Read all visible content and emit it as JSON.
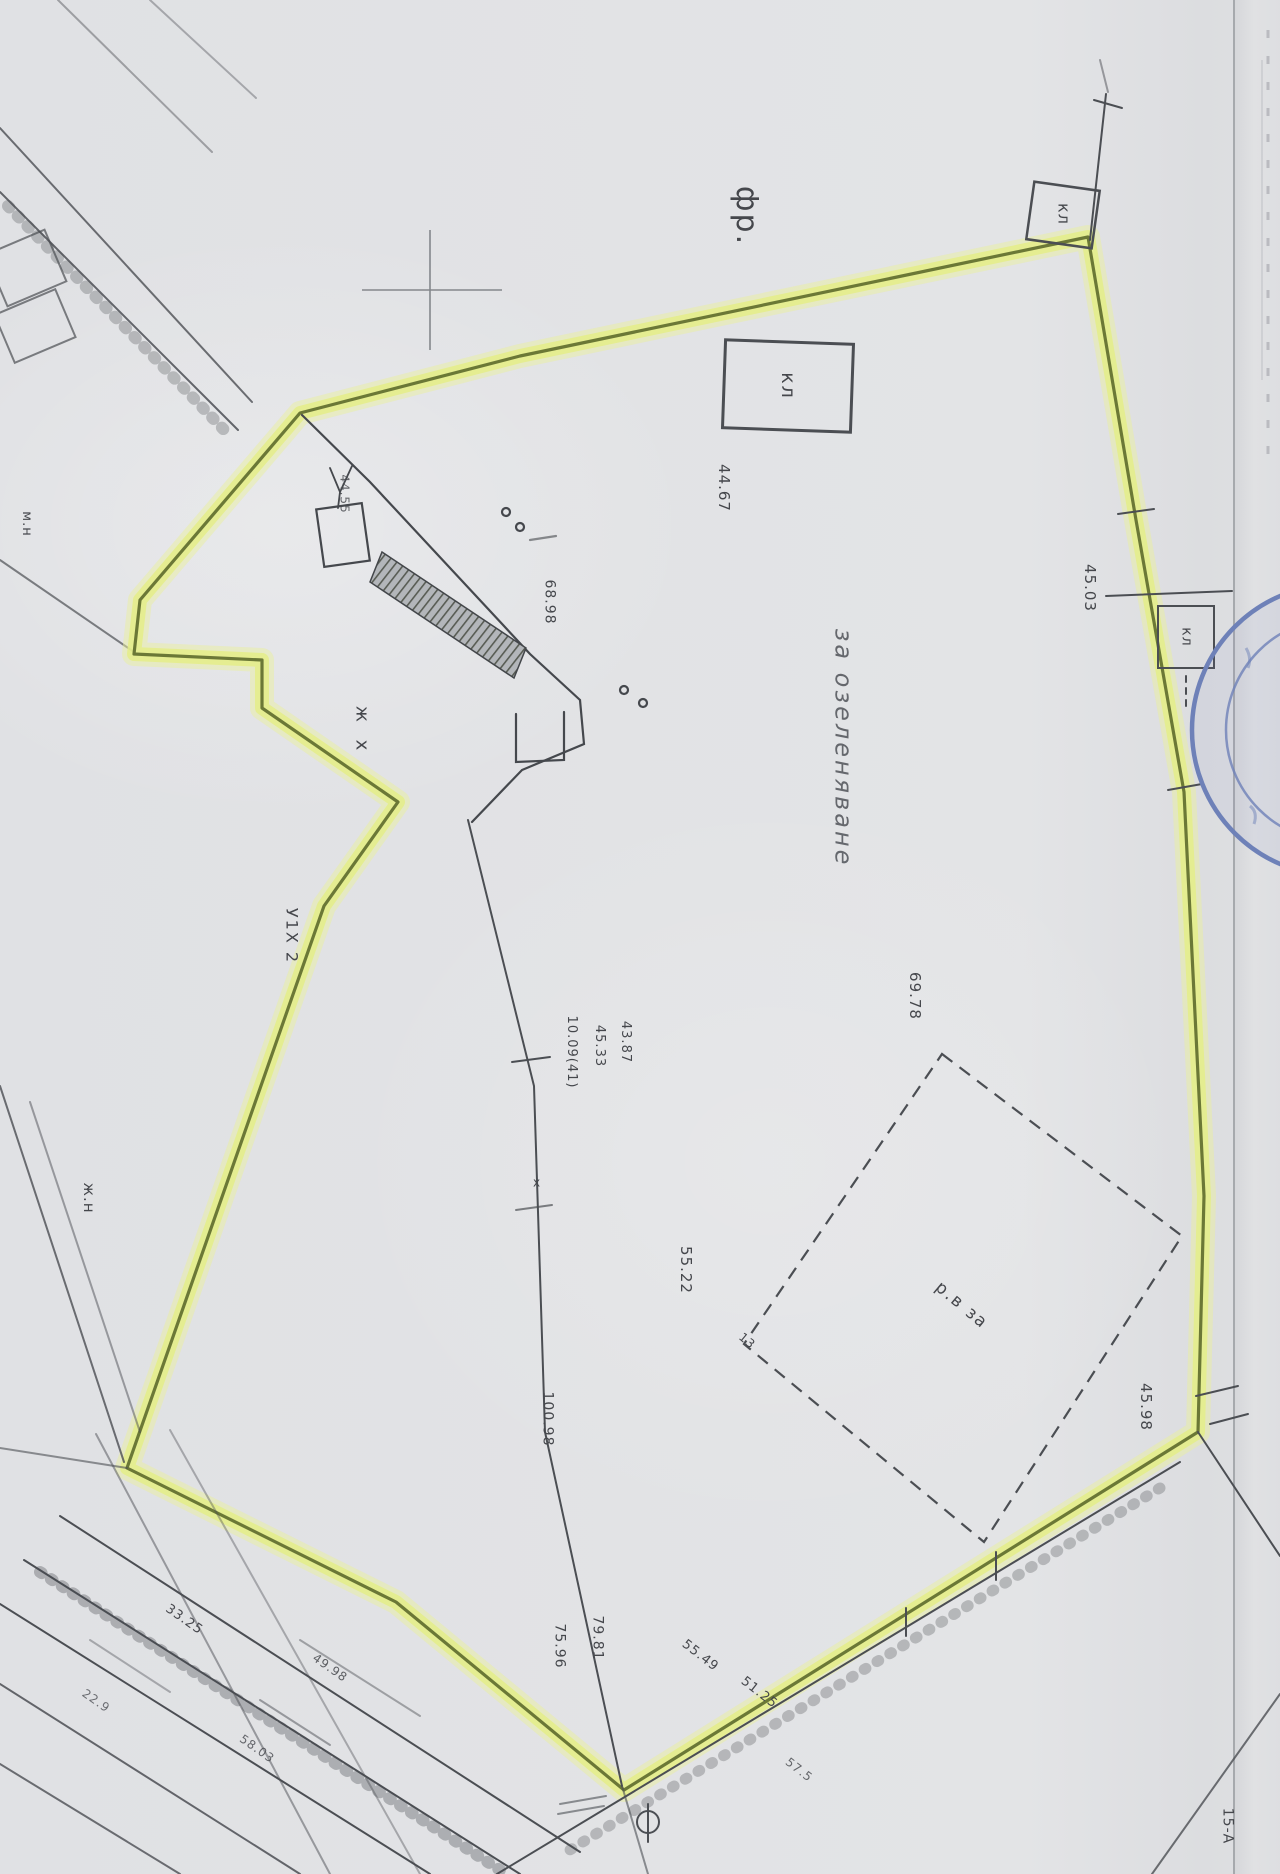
{
  "colors": {
    "paper": "#e2e3e5",
    "ink": "#4b4e53",
    "highlight_fill": "rgba(228,237,136,0.85)",
    "highlight_line": "#6b7836",
    "stamp_blue": "#6e81b8",
    "cross_gray": "#84878c"
  },
  "scan": {
    "kind_label": "cadastral plan scan",
    "highlighted_area": "parcel boundary marked with yellow highlighter"
  },
  "labels": [
    {
      "name": "label-fr",
      "text": "фр.",
      "x": 746,
      "y": 216,
      "rot": 90,
      "fs": 30,
      "ls": 2
    },
    {
      "name": "label-kl-top-right-box",
      "text": "кл",
      "x": 1063,
      "y": 214,
      "rot": 90,
      "fs": 16,
      "ls": 1
    },
    {
      "name": "label-kl-top-box",
      "text": "кл",
      "x": 787,
      "y": 386,
      "rot": 90,
      "fs": 19,
      "ls": 2
    },
    {
      "name": "measurement-44-67",
      "text": "44.67",
      "x": 723,
      "y": 488,
      "rot": 90,
      "fs": 15
    },
    {
      "name": "measurement-68-98",
      "text": "68.98",
      "x": 549,
      "y": 602,
      "rot": 90,
      "fs": 14
    },
    {
      "name": "measurement-45-03",
      "text": "45.03",
      "x": 1089,
      "y": 588,
      "rot": 90,
      "fs": 15
    },
    {
      "name": "label-kl-right-box",
      "text": "кл",
      "x": 1186,
      "y": 637,
      "rot": 90,
      "fs": 14
    },
    {
      "name": "note-center",
      "text": "за озеленяване",
      "x": 843,
      "y": 748,
      "rot": 90,
      "fs": 24,
      "ls": 3,
      "italic": true,
      "color": "#585b61",
      "op": 0.9
    },
    {
      "name": "label-zh-x",
      "text": "ж х",
      "x": 361,
      "y": 731,
      "rot": 90,
      "fs": 18,
      "ls": 6
    },
    {
      "name": "label-upi",
      "text": "У1Х 2",
      "x": 291,
      "y": 936,
      "rot": 90,
      "fs": 16,
      "ls": 2
    },
    {
      "name": "label-m-n",
      "text": "м.н",
      "x": 26,
      "y": 524,
      "rot": 90,
      "fs": 13
    },
    {
      "name": "label-zh-n",
      "text": "ж.н",
      "x": 88,
      "y": 1198,
      "rot": 90,
      "fs": 15
    },
    {
      "name": "measurement-69-78",
      "text": "69.78",
      "x": 914,
      "y": 996,
      "rot": 90,
      "fs": 15
    },
    {
      "name": "measurement-10-09",
      "text": "10.09(41)",
      "x": 571,
      "y": 1052,
      "rot": 90,
      "fs": 13
    },
    {
      "name": "measurement-45-33",
      "text": "45.33",
      "x": 599,
      "y": 1046,
      "rot": 90,
      "fs": 13
    },
    {
      "name": "measurement-43-87",
      "text": "43.87",
      "x": 625,
      "y": 1042,
      "rot": 90,
      "fs": 13
    },
    {
      "name": "measurement-55-22",
      "text": "55.22",
      "x": 685,
      "y": 1270,
      "rot": 90,
      "fs": 15
    },
    {
      "name": "measurement-13",
      "text": "13",
      "x": 747,
      "y": 1341,
      "rot": 40,
      "fs": 12
    },
    {
      "name": "note-diamond",
      "text": "р.в за",
      "x": 961,
      "y": 1306,
      "rot": 40,
      "fs": 17,
      "ls": 2
    },
    {
      "name": "measurement-100-98",
      "text": "100.98",
      "x": 547,
      "y": 1419,
      "rot": 90,
      "fs": 14
    },
    {
      "name": "measurement-45-98",
      "text": "45.98",
      "x": 1145,
      "y": 1407,
      "rot": 90,
      "fs": 15
    },
    {
      "name": "measurement-75-96",
      "text": "75.96",
      "x": 559,
      "y": 1646,
      "rot": 90,
      "fs": 14
    },
    {
      "name": "measurement-79-81",
      "text": "79.81",
      "x": 597,
      "y": 1638,
      "rot": 90,
      "fs": 14
    },
    {
      "name": "measurement-55-49",
      "text": "55.49",
      "x": 700,
      "y": 1656,
      "rot": 38,
      "fs": 13
    },
    {
      "name": "measurement-51-25",
      "text": "51.25",
      "x": 759,
      "y": 1693,
      "rot": 38,
      "fs": 13
    },
    {
      "name": "measurement-57-5",
      "text": "57.5",
      "x": 799,
      "y": 1770,
      "rot": 38,
      "fs": 12,
      "op": 0.8
    },
    {
      "name": "measurement-33-25",
      "text": "33.25",
      "x": 184,
      "y": 1620,
      "rot": 35,
      "fs": 13
    },
    {
      "name": "measurement-49-98",
      "text": "49.98",
      "x": 330,
      "y": 1668,
      "rot": 35,
      "fs": 12,
      "op": 0.85
    },
    {
      "name": "measurement-58-03",
      "text": "58.03",
      "x": 257,
      "y": 1749,
      "rot": 35,
      "fs": 12,
      "op": 0.8
    },
    {
      "name": "measurement-22-9",
      "text": "22.9",
      "x": 96,
      "y": 1701,
      "rot": 35,
      "fs": 12,
      "op": 0.75
    },
    {
      "name": "label-plot-15a",
      "text": "15-А",
      "x": 1227,
      "y": 1826,
      "rot": 90,
      "fs": 14
    },
    {
      "name": "measurement-44-55",
      "text": "44.55",
      "x": 344,
      "y": 494,
      "rot": 90,
      "fs": 12,
      "op": 0.8
    },
    {
      "name": "label-x-mark",
      "text": "х",
      "x": 537,
      "y": 1183,
      "rot": 0,
      "fs": 12
    }
  ]
}
